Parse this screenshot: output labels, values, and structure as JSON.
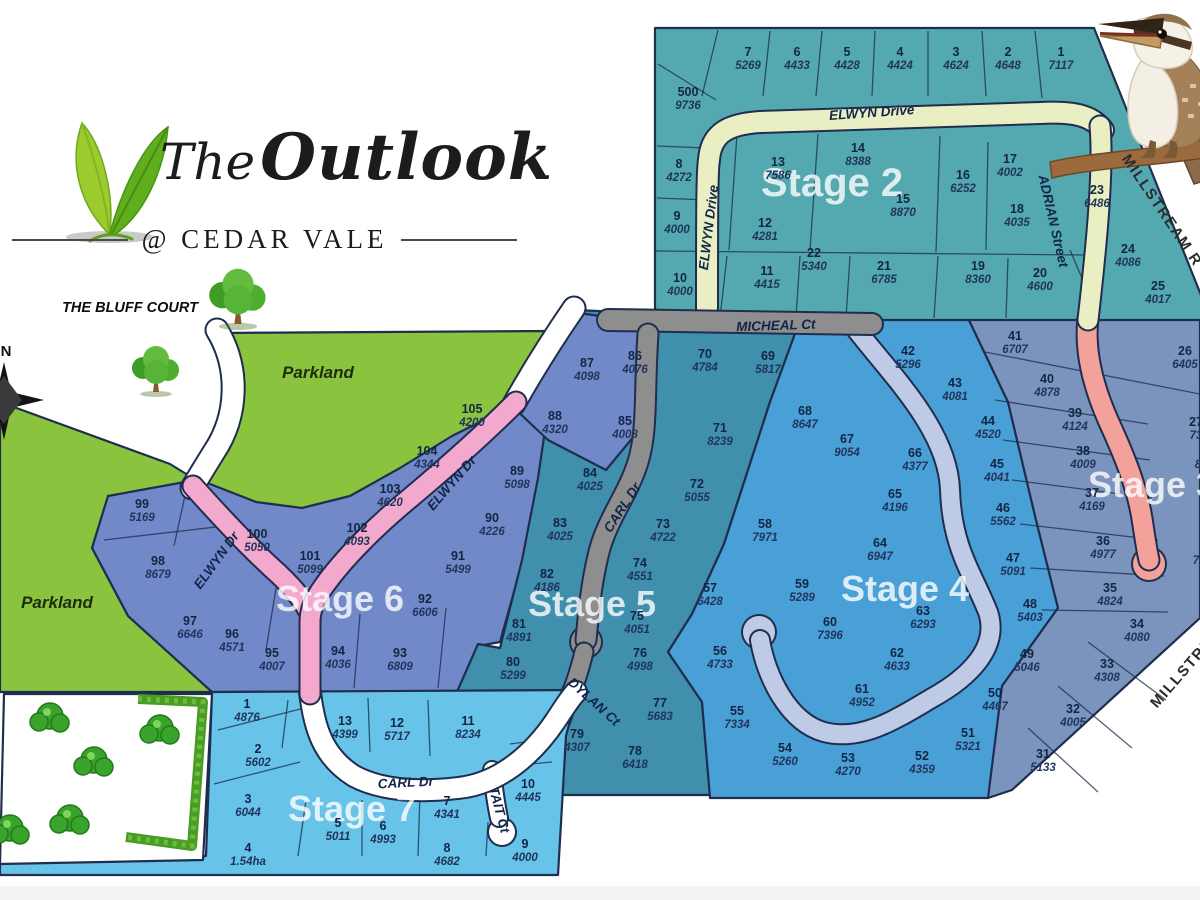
{
  "title": {
    "brand_the": "The",
    "brand_name": "Outlook",
    "subtitle": "@ CEDAR VALE"
  },
  "map_labels": {
    "bluff_court": "THE BLUFF COURT",
    "parkland_upper": "Parkland",
    "parkland_left": "Parkland",
    "compass_north": "N"
  },
  "colors": {
    "stage2": "#54a9b0",
    "stage3": "#7b94bd",
    "stage4": "#49a0d6",
    "stage5": "#3f8fad",
    "stage6": "#7289c9",
    "stage7": "#67c3e8",
    "parkland": "#8ac43e",
    "road_pale": "#e9efc3",
    "road_pink": "#f3a9ce",
    "road_salmon": "#f2a29b",
    "road_lavender": "#bfcae6",
    "road_gray": "#8e8e8e",
    "road_white": "#ffffff",
    "casing": "#1f2d4e"
  },
  "stages": [
    {
      "key": "stage-2",
      "label": "Stage 2",
      "fill": "#54a9b0",
      "label_pos": [
        832,
        196
      ],
      "label_size": 40,
      "lots": [
        {
          "n": "7",
          "a": "5269",
          "x": 748,
          "y": 56
        },
        {
          "n": "6",
          "a": "4433",
          "x": 797,
          "y": 56
        },
        {
          "n": "5",
          "a": "4428",
          "x": 847,
          "y": 56
        },
        {
          "n": "4",
          "a": "4424",
          "x": 900,
          "y": 56
        },
        {
          "n": "3",
          "a": "4624",
          "x": 956,
          "y": 56
        },
        {
          "n": "2",
          "a": "4648",
          "x": 1008,
          "y": 56
        },
        {
          "n": "1",
          "a": "7117",
          "x": 1061,
          "y": 56
        },
        {
          "n": "500",
          "a": "9736",
          "x": 688,
          "y": 96
        },
        {
          "n": "8",
          "a": "4272",
          "x": 679,
          "y": 168
        },
        {
          "n": "13",
          "a": "7586",
          "x": 778,
          "y": 166
        },
        {
          "n": "14",
          "a": "8388",
          "x": 858,
          "y": 152
        },
        {
          "n": "17",
          "a": "4002",
          "x": 1010,
          "y": 163
        },
        {
          "n": "16",
          "a": "6252",
          "x": 963,
          "y": 179
        },
        {
          "n": "15",
          "a": "8870",
          "x": 903,
          "y": 203
        },
        {
          "n": "23",
          "a": "6486",
          "x": 1097,
          "y": 194
        },
        {
          "n": "9",
          "a": "4000",
          "x": 677,
          "y": 220
        },
        {
          "n": "12",
          "a": "4281",
          "x": 765,
          "y": 227
        },
        {
          "n": "18",
          "a": "4035",
          "x": 1017,
          "y": 213
        },
        {
          "n": "22",
          "a": "5340",
          "x": 814,
          "y": 257
        },
        {
          "n": "24",
          "a": "4086",
          "x": 1128,
          "y": 253
        },
        {
          "n": "10",
          "a": "4000",
          "x": 680,
          "y": 282
        },
        {
          "n": "11",
          "a": "4415",
          "x": 767,
          "y": 275
        },
        {
          "n": "21",
          "a": "6785",
          "x": 884,
          "y": 270
        },
        {
          "n": "19",
          "a": "8360",
          "x": 978,
          "y": 270
        },
        {
          "n": "20",
          "a": "4600",
          "x": 1040,
          "y": 277
        },
        {
          "n": "25",
          "a": "4017",
          "x": 1158,
          "y": 290
        }
      ]
    },
    {
      "key": "stage-3",
      "label": "Stage 3",
      "fill": "#7b94bd",
      "label_pos": [
        1152,
        497
      ],
      "label_size": 36,
      "lots": [
        {
          "n": "41",
          "a": "6707",
          "x": 1015,
          "y": 340
        },
        {
          "n": "26",
          "a": "6405",
          "x": 1185,
          "y": 355
        },
        {
          "n": "40",
          "a": "4878",
          "x": 1047,
          "y": 383
        },
        {
          "n": "27",
          "a": "73",
          "x": 1196,
          "y": 426
        },
        {
          "n": "39",
          "a": "4124",
          "x": 1075,
          "y": 417
        },
        {
          "n": "",
          "a": "8",
          "x": 1198,
          "y": 455
        },
        {
          "n": "38",
          "a": "4009",
          "x": 1083,
          "y": 455
        },
        {
          "n": "37",
          "a": "4169",
          "x": 1092,
          "y": 497
        },
        {
          "n": "",
          "a": "7",
          "x": 1196,
          "y": 551
        },
        {
          "n": "36",
          "a": "4977",
          "x": 1103,
          "y": 545
        },
        {
          "n": "35",
          "a": "4824",
          "x": 1110,
          "y": 592
        },
        {
          "n": "34",
          "a": "4080",
          "x": 1137,
          "y": 628
        },
        {
          "n": "33",
          "a": "4308",
          "x": 1107,
          "y": 668
        },
        {
          "n": "32",
          "a": "4005",
          "x": 1073,
          "y": 713
        },
        {
          "n": "31",
          "a": "5133",
          "x": 1043,
          "y": 758
        }
      ]
    },
    {
      "key": "stage-4",
      "label": "Stage 4",
      "fill": "#49a0d6",
      "label_pos": [
        905,
        601
      ],
      "label_size": 36,
      "lots": [
        {
          "n": "42",
          "a": "5296",
          "x": 908,
          "y": 355
        },
        {
          "n": "43",
          "a": "4081",
          "x": 955,
          "y": 387
        },
        {
          "n": "44",
          "a": "4520",
          "x": 988,
          "y": 425
        },
        {
          "n": "66",
          "a": "4377",
          "x": 915,
          "y": 457
        },
        {
          "n": "45",
          "a": "4041",
          "x": 997,
          "y": 468
        },
        {
          "n": "65",
          "a": "4196",
          "x": 895,
          "y": 498
        },
        {
          "n": "46",
          "a": "5562",
          "x": 1003,
          "y": 512
        },
        {
          "n": "64",
          "a": "6947",
          "x": 880,
          "y": 547
        },
        {
          "n": "47",
          "a": "5091",
          "x": 1013,
          "y": 562
        },
        {
          "n": "68",
          "a": "8647",
          "x": 805,
          "y": 415
        },
        {
          "n": "67",
          "a": "9054",
          "x": 847,
          "y": 443
        },
        {
          "n": "58",
          "a": "7971",
          "x": 765,
          "y": 528
        },
        {
          "n": "48",
          "a": "5403",
          "x": 1030,
          "y": 608
        },
        {
          "n": "63",
          "a": "6293",
          "x": 923,
          "y": 615
        },
        {
          "n": "59",
          "a": "5289",
          "x": 802,
          "y": 588
        },
        {
          "n": "60",
          "a": "7396",
          "x": 830,
          "y": 626
        },
        {
          "n": "57",
          "a": "6428",
          "x": 710,
          "y": 592
        },
        {
          "n": "62",
          "a": "4633",
          "x": 897,
          "y": 657
        },
        {
          "n": "61",
          "a": "4952",
          "x": 862,
          "y": 693
        },
        {
          "n": "56",
          "a": "4733",
          "x": 720,
          "y": 655
        },
        {
          "n": "55",
          "a": "7334",
          "x": 737,
          "y": 715
        },
        {
          "n": "49",
          "a": "5046",
          "x": 1027,
          "y": 658
        },
        {
          "n": "50",
          "a": "4467",
          "x": 995,
          "y": 697
        },
        {
          "n": "51",
          "a": "5321",
          "x": 968,
          "y": 737
        },
        {
          "n": "52",
          "a": "4359",
          "x": 922,
          "y": 760
        },
        {
          "n": "53",
          "a": "4270",
          "x": 848,
          "y": 762
        },
        {
          "n": "54",
          "a": "5260",
          "x": 785,
          "y": 752
        }
      ]
    },
    {
      "key": "stage-5",
      "label": "Stage 5",
      "fill": "#3f8fad",
      "label_pos": [
        592,
        616
      ],
      "label_size": 36,
      "lots": [
        {
          "n": "86",
          "a": "4076",
          "x": 635,
          "y": 360
        },
        {
          "n": "70",
          "a": "4784",
          "x": 705,
          "y": 358
        },
        {
          "n": "69",
          "a": "5817",
          "x": 768,
          "y": 360
        },
        {
          "n": "85",
          "a": "4008",
          "x": 625,
          "y": 425
        },
        {
          "n": "71",
          "a": "8239",
          "x": 720,
          "y": 432
        },
        {
          "n": "84",
          "a": "4025",
          "x": 590,
          "y": 477
        },
        {
          "n": "72",
          "a": "5055",
          "x": 697,
          "y": 488
        },
        {
          "n": "83",
          "a": "4025",
          "x": 560,
          "y": 527
        },
        {
          "n": "73",
          "a": "4722",
          "x": 663,
          "y": 528
        },
        {
          "n": "74",
          "a": "4551",
          "x": 640,
          "y": 567
        },
        {
          "n": "82",
          "a": "4186",
          "x": 547,
          "y": 578
        },
        {
          "n": "75",
          "a": "4051",
          "x": 637,
          "y": 620
        },
        {
          "n": "76",
          "a": "4998",
          "x": 640,
          "y": 657
        },
        {
          "n": "81",
          "a": "4891",
          "x": 519,
          "y": 628
        },
        {
          "n": "80",
          "a": "5299",
          "x": 513,
          "y": 666
        },
        {
          "n": "77",
          "a": "5683",
          "x": 660,
          "y": 707
        },
        {
          "n": "79",
          "a": "4307",
          "x": 577,
          "y": 738
        },
        {
          "n": "78",
          "a": "6418",
          "x": 635,
          "y": 755
        }
      ]
    },
    {
      "key": "stage-6",
      "label": "Stage 6",
      "fill": "#7289c9",
      "label_pos": [
        340,
        611
      ],
      "label_size": 36,
      "lots": [
        {
          "n": "87",
          "a": "4098",
          "x": 587,
          "y": 367
        },
        {
          "n": "88",
          "a": "4320",
          "x": 555,
          "y": 420
        },
        {
          "n": "89",
          "a": "5098",
          "x": 517,
          "y": 475
        },
        {
          "n": "90",
          "a": "4226",
          "x": 492,
          "y": 522
        },
        {
          "n": "91",
          "a": "5499",
          "x": 458,
          "y": 560
        },
        {
          "n": "92",
          "a": "6606",
          "x": 425,
          "y": 603
        },
        {
          "n": "105",
          "a": "4200",
          "x": 472,
          "y": 413
        },
        {
          "n": "104",
          "a": "4344",
          "x": 427,
          "y": 455
        },
        {
          "n": "103",
          "a": "4620",
          "x": 390,
          "y": 493
        },
        {
          "n": "102",
          "a": "4093",
          "x": 357,
          "y": 532
        },
        {
          "n": "101",
          "a": "5099",
          "x": 310,
          "y": 560
        },
        {
          "n": "100",
          "a": "5050",
          "x": 257,
          "y": 538
        },
        {
          "n": "99",
          "a": "5169",
          "x": 142,
          "y": 508
        },
        {
          "n": "98",
          "a": "8679",
          "x": 158,
          "y": 565
        },
        {
          "n": "97",
          "a": "6646",
          "x": 190,
          "y": 625
        },
        {
          "n": "96",
          "a": "4571",
          "x": 232,
          "y": 638
        },
        {
          "n": "95",
          "a": "4007",
          "x": 272,
          "y": 657
        },
        {
          "n": "94",
          "a": "4036",
          "x": 338,
          "y": 655
        },
        {
          "n": "93",
          "a": "6809",
          "x": 400,
          "y": 657
        }
      ]
    },
    {
      "key": "stage-7",
      "label": "Stage 7",
      "fill": "#67c3e8",
      "label_pos": [
        352,
        821
      ],
      "label_size": 36,
      "lots": [
        {
          "n": "1",
          "a": "4876",
          "x": 247,
          "y": 708
        },
        {
          "n": "2",
          "a": "5602",
          "x": 258,
          "y": 753
        },
        {
          "n": "13",
          "a": "4399",
          "x": 345,
          "y": 725
        },
        {
          "n": "12",
          "a": "5717",
          "x": 397,
          "y": 727
        },
        {
          "n": "11",
          "a": "8234",
          "x": 468,
          "y": 725
        },
        {
          "n": "3",
          "a": "6044",
          "x": 248,
          "y": 803
        },
        {
          "n": "5",
          "a": "5011",
          "x": 338,
          "y": 827
        },
        {
          "n": "6",
          "a": "4993",
          "x": 383,
          "y": 830
        },
        {
          "n": "7",
          "a": "4341",
          "x": 447,
          "y": 805
        },
        {
          "n": "10",
          "a": "4445",
          "x": 528,
          "y": 788
        },
        {
          "n": "4",
          "a": "1.54ha",
          "x": 248,
          "y": 852
        },
        {
          "n": "8",
          "a": "4682",
          "x": 447,
          "y": 852
        },
        {
          "n": "9",
          "a": "4000",
          "x": 525,
          "y": 848
        }
      ]
    }
  ],
  "roads": [
    {
      "key": "elwyn-drive-top",
      "label": "ELWYN Drive",
      "x": 872,
      "y": 117,
      "rot": -4,
      "cls": "dark"
    },
    {
      "key": "elwyn-drive-west",
      "label": "ELWYN Drive",
      "x": 713,
      "y": 228,
      "rot": -83,
      "cls": "dark"
    },
    {
      "key": "adrian-street",
      "label": "ADRIAN Street",
      "x": 1049,
      "y": 222,
      "rot": 77,
      "cls": "dark"
    },
    {
      "key": "micheal-ct",
      "label": "MICHEAL Ct",
      "x": 776,
      "y": 330,
      "rot": -2,
      "cls": "dark"
    },
    {
      "key": "carl-dr-north",
      "label": "CARL Dr",
      "x": 626,
      "y": 510,
      "rot": -57,
      "cls": "dark"
    },
    {
      "key": "dylan-ct",
      "label": "DYLAN Ct",
      "x": 591,
      "y": 705,
      "rot": 42,
      "cls": "dark"
    },
    {
      "key": "carl-dr-south",
      "label": "CARL Dr",
      "x": 406,
      "y": 787,
      "rot": -3,
      "cls": "dark"
    },
    {
      "key": "tait-ct",
      "label": "TAIT Ct",
      "x": 495,
      "y": 811,
      "rot": 75,
      "cls": "dark"
    },
    {
      "key": "elwyn-dr-pink-east",
      "label": "ELWYN Dr",
      "x": 455,
      "y": 486,
      "rot": -49,
      "cls": "dark"
    },
    {
      "key": "elwyn-dr-pink-west",
      "label": "ELWYN Dr",
      "x": 220,
      "y": 563,
      "rot": -54,
      "cls": "dark"
    },
    {
      "key": "millstream-north",
      "label": "MILLSTREAM R",
      "x": 1158,
      "y": 213,
      "rot": 56,
      "cls": "plain"
    },
    {
      "key": "millstream-south",
      "label": "MILLSTREAM",
      "x": 1194,
      "y": 666,
      "rot": -49,
      "cls": "plain"
    }
  ]
}
